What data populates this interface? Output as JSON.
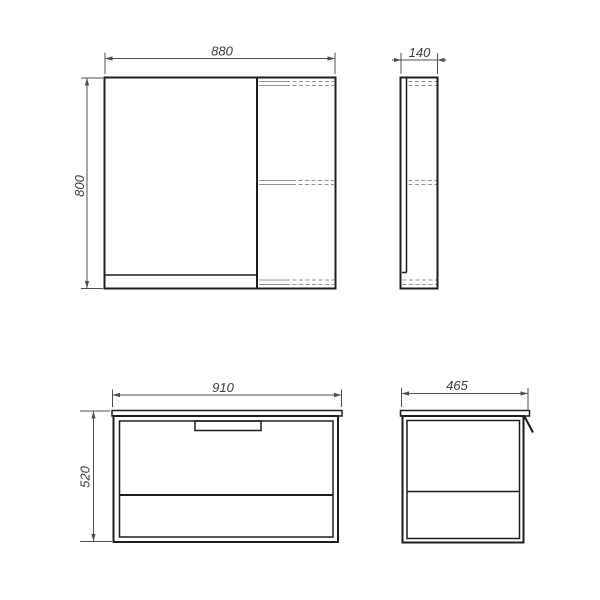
{
  "palette": {
    "bg": "#ffffff",
    "outline": "#1d1d1d",
    "dim": "#4f4f4f",
    "hidden": "#949494",
    "text": "#3c3c3c"
  },
  "dims": {
    "mirror_width": "880",
    "mirror_height": "800",
    "mirror_depth": "140",
    "vanity_width": "910",
    "vanity_height": "520",
    "vanity_depth": "465"
  }
}
